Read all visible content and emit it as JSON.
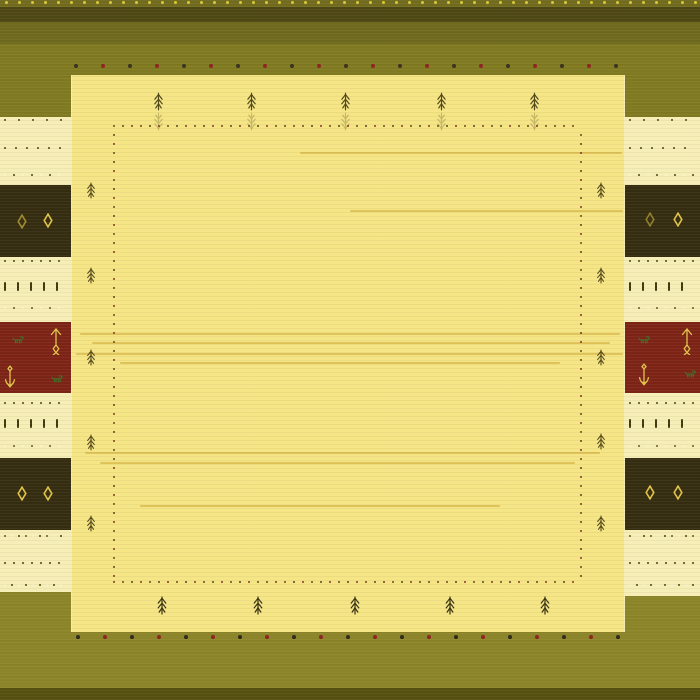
{
  "scene": {
    "name": "yellow-gabbeh-rug"
  },
  "palette": {
    "top_selvedge": "#716b1e",
    "top_dark": "#4d4714",
    "olive_dark": "#6e691d",
    "olive": "#7f7a21",
    "olive_bright": "#8b8428",
    "bottom_dark": "#55500f",
    "field": "#f5e585",
    "margin_cream": "#f6eeb6",
    "block_dark": "#342c10",
    "block_red": "#7c2316",
    "gold": "#e2c44a",
    "motif_green": "#3f6d28",
    "selvedge_dot_yellow": "#d8c733",
    "guard_dot_dark": "#38301f",
    "guard_dot_red": "#8e2121"
  },
  "rug": {
    "regions": [
      {
        "name": "top-selvedge-band",
        "x": 0,
        "y": 0,
        "w": 700,
        "h": 7,
        "color": "#716b1e",
        "tex": "olive"
      },
      {
        "name": "top-dark-band",
        "x": 0,
        "y": 7,
        "w": 700,
        "h": 15,
        "color": "#4d4714",
        "tex": "olive"
      },
      {
        "name": "top-olive-dark-band",
        "x": 0,
        "y": 22,
        "w": 700,
        "h": 22,
        "color": "#6e691d",
        "tex": "olive"
      },
      {
        "name": "top-olive-band",
        "x": 0,
        "y": 44,
        "w": 700,
        "h": 31,
        "color": "#7f7a21",
        "tex": "olive"
      },
      {
        "name": "bottom-olive-band",
        "x": 0,
        "y": 632,
        "w": 700,
        "h": 56,
        "color": "#8b8428",
        "tex": "olive"
      },
      {
        "name": "bottom-dark-band",
        "x": 0,
        "y": 688,
        "w": 700,
        "h": 12,
        "color": "#55500f",
        "tex": "olive"
      },
      {
        "name": "left-margin",
        "x": 0,
        "y": 75,
        "w": 72,
        "h": 557,
        "color": "#f6eeb6",
        "tex": "cream"
      },
      {
        "name": "right-margin",
        "x": 624,
        "y": 75,
        "w": 76,
        "h": 557,
        "color": "#f6eeb6",
        "tex": "cream"
      },
      {
        "name": "field",
        "x": 72,
        "y": 75,
        "w": 552,
        "h": 557,
        "color": "#f5e585",
        "tex": "field"
      },
      {
        "name": "left-olive-block-top",
        "x": 0,
        "y": 75,
        "w": 71,
        "h": 42,
        "color": "#7f7a21",
        "tex": "olive"
      },
      {
        "name": "right-olive-block-top",
        "x": 625,
        "y": 75,
        "w": 75,
        "h": 42,
        "color": "#7f7a21",
        "tex": "olive"
      },
      {
        "name": "left-dark-block-top",
        "x": 0,
        "y": 185,
        "w": 71,
        "h": 72,
        "color": "#342c10",
        "tex": "dark"
      },
      {
        "name": "right-dark-block-top",
        "x": 625,
        "y": 185,
        "w": 75,
        "h": 72,
        "color": "#342c10",
        "tex": "dark"
      },
      {
        "name": "left-red-block",
        "x": 0,
        "y": 322,
        "w": 71,
        "h": 71,
        "color": "#7c2316",
        "tex": "red"
      },
      {
        "name": "right-red-block",
        "x": 625,
        "y": 322,
        "w": 75,
        "h": 71,
        "color": "#7c2316",
        "tex": "red"
      },
      {
        "name": "left-dark-block-bottom",
        "x": 0,
        "y": 458,
        "w": 71,
        "h": 72,
        "color": "#342c10",
        "tex": "dark"
      },
      {
        "name": "right-dark-block-bottom",
        "x": 625,
        "y": 458,
        "w": 75,
        "h": 72,
        "color": "#342c10",
        "tex": "dark"
      },
      {
        "name": "left-olive-block-bottom",
        "x": 0,
        "y": 592,
        "w": 71,
        "h": 40,
        "color": "#8b8428",
        "tex": "olive"
      },
      {
        "name": "right-olive-block-bottom",
        "x": 625,
        "y": 596,
        "w": 75,
        "h": 36,
        "color": "#8b8428",
        "tex": "olive"
      }
    ],
    "field_streaks": [
      {
        "y": 152,
        "x1": 300,
        "x2": 622
      },
      {
        "y": 210,
        "x1": 350,
        "x2": 623
      },
      {
        "y": 333,
        "x1": 80,
        "x2": 620
      },
      {
        "y": 342,
        "x1": 92,
        "x2": 610
      },
      {
        "y": 353,
        "x1": 76,
        "x2": 623
      },
      {
        "y": 362,
        "x1": 120,
        "x2": 560
      },
      {
        "y": 452,
        "x1": 85,
        "x2": 600
      },
      {
        "y": 462,
        "x1": 100,
        "x2": 575
      },
      {
        "y": 505,
        "x1": 140,
        "x2": 500
      }
    ],
    "streak_color": "#c89e2a",
    "dot_rows": [
      {
        "name": "selvedge-dot-row",
        "y": 2,
        "x1": 6,
        "x2": 696,
        "step": 13,
        "size": 3,
        "colors": [
          "#d8c733"
        ]
      },
      {
        "name": "top-guard-dot-row",
        "y": 66,
        "x1": 76,
        "x2": 622,
        "step": 27,
        "size": 4,
        "colors": [
          "#38301f",
          "#8e2121"
        ]
      },
      {
        "name": "bottom-guard-dot-row",
        "y": 637,
        "x1": 78,
        "x2": 626,
        "step": 27,
        "size": 4,
        "colors": [
          "#2c281a",
          "#8e2121"
        ]
      }
    ],
    "inner_border": {
      "name": "inner-dotted-border",
      "x1": 114,
      "y1": 126,
      "x2": 581,
      "y2": 582,
      "step": 9,
      "size": 2.6,
      "colors": [
        "#6f421b",
        "#803024",
        "#57401f"
      ]
    },
    "margin_rows": {
      "left": {
        "x1": 5,
        "x2": 66
      },
      "right": {
        "x1": 630,
        "x2": 694
      },
      "rows": [
        {
          "y": 120,
          "type": "dot",
          "step": 14,
          "size": 2.6,
          "colors": [
            "#4a4012"
          ]
        },
        {
          "y": 148,
          "type": "dot",
          "step": 11,
          "size": 2.2,
          "colors": [
            "#4a4012"
          ]
        },
        {
          "y": 175,
          "type": "dot",
          "step": 9,
          "size": 2.4,
          "colors": [
            "#faf3d2",
            "#4a4012"
          ]
        },
        {
          "y": 261,
          "type": "dot",
          "step": 9,
          "size": 2.2,
          "colors": [
            "#454211"
          ]
        },
        {
          "y": 286,
          "type": "dash",
          "step": 13,
          "w": 2,
          "h": 9,
          "colors": [
            "#3e390e"
          ]
        },
        {
          "y": 308,
          "type": "dot",
          "step": 9,
          "size": 2.2,
          "colors": [
            "#faf3d2",
            "#6a5a20"
          ]
        },
        {
          "y": 403,
          "type": "dot",
          "step": 9,
          "size": 2.2,
          "colors": [
            "#454211"
          ]
        },
        {
          "y": 423,
          "type": "dash",
          "step": 13,
          "w": 2,
          "h": 9,
          "colors": [
            "#3e390e"
          ]
        },
        {
          "y": 446,
          "type": "dot",
          "step": 9,
          "size": 2.2,
          "colors": [
            "#faf3d2",
            "#6a5a20"
          ]
        },
        {
          "y": 536,
          "type": "dot",
          "step": 7,
          "size": 2,
          "colors": [
            "#6a5a20",
            "#faf3d2",
            "#4a4012"
          ]
        },
        {
          "y": 563,
          "type": "dot",
          "step": 9,
          "size": 2.6,
          "colors": [
            "#4a4012"
          ]
        },
        {
          "y": 585,
          "type": "dot",
          "step": 7,
          "size": 2,
          "colors": [
            "#faf3d2",
            "#4a4012"
          ]
        }
      ]
    },
    "motifs": {
      "trees": [
        {
          "x": 158,
          "y": 92,
          "w": 11,
          "h": 19,
          "color": "#4f4716",
          "reflect": true
        },
        {
          "x": 251,
          "y": 92,
          "w": 11,
          "h": 19,
          "color": "#4f4716",
          "reflect": true
        },
        {
          "x": 345,
          "y": 92,
          "w": 11,
          "h": 19,
          "color": "#4f4716",
          "reflect": true
        },
        {
          "x": 441,
          "y": 92,
          "w": 11,
          "h": 19,
          "color": "#4f4716",
          "reflect": true
        },
        {
          "x": 534,
          "y": 92,
          "w": 11,
          "h": 19,
          "color": "#4f4716",
          "reflect": true
        },
        {
          "x": 162,
          "y": 596,
          "w": 12,
          "h": 19,
          "color": "#3a3414",
          "reflect": false
        },
        {
          "x": 258,
          "y": 596,
          "w": 12,
          "h": 19,
          "color": "#3a3414",
          "reflect": false
        },
        {
          "x": 355,
          "y": 596,
          "w": 12,
          "h": 19,
          "color": "#3a3414",
          "reflect": false
        },
        {
          "x": 450,
          "y": 596,
          "w": 12,
          "h": 19,
          "color": "#3a3414",
          "reflect": false
        },
        {
          "x": 545,
          "y": 596,
          "w": 12,
          "h": 19,
          "color": "#3a3414",
          "reflect": false
        },
        {
          "x": 91,
          "y": 182,
          "w": 10,
          "h": 17,
          "color": "#55491a",
          "reflect": false
        },
        {
          "x": 91,
          "y": 267,
          "w": 10,
          "h": 17,
          "color": "#55491a",
          "reflect": false
        },
        {
          "x": 91,
          "y": 349,
          "w": 10,
          "h": 17,
          "color": "#55491a",
          "reflect": false
        },
        {
          "x": 91,
          "y": 434,
          "w": 10,
          "h": 17,
          "color": "#55491a",
          "reflect": false
        },
        {
          "x": 91,
          "y": 515,
          "w": 10,
          "h": 17,
          "color": "#55491a",
          "reflect": false
        },
        {
          "x": 601,
          "y": 182,
          "w": 10,
          "h": 17,
          "color": "#55491a",
          "reflect": false
        },
        {
          "x": 601,
          "y": 267,
          "w": 10,
          "h": 17,
          "color": "#55491a",
          "reflect": false
        },
        {
          "x": 601,
          "y": 349,
          "w": 10,
          "h": 17,
          "color": "#55491a",
          "reflect": false
        },
        {
          "x": 601,
          "y": 433,
          "w": 10,
          "h": 17,
          "color": "#55491a",
          "reflect": false
        },
        {
          "x": 601,
          "y": 515,
          "w": 10,
          "h": 17,
          "color": "#55491a",
          "reflect": false
        }
      ],
      "diamonds": [
        {
          "x": 22,
          "y": 214,
          "w": 10,
          "h": 15,
          "color": "#a08c2c"
        },
        {
          "x": 48,
          "y": 213,
          "w": 10,
          "h": 15,
          "color": "#e2c44a"
        },
        {
          "x": 650,
          "y": 212,
          "w": 10,
          "h": 15,
          "color": "#8f7f2a"
        },
        {
          "x": 678,
          "y": 212,
          "w": 10,
          "h": 15,
          "color": "#e2c44a"
        },
        {
          "x": 22,
          "y": 486,
          "w": 10,
          "h": 15,
          "color": "#e2c44a"
        },
        {
          "x": 48,
          "y": 486,
          "w": 10,
          "h": 15,
          "color": "#e2c44a"
        },
        {
          "x": 650,
          "y": 485,
          "w": 10,
          "h": 15,
          "color": "#e2c44a"
        },
        {
          "x": 678,
          "y": 485,
          "w": 10,
          "h": 15,
          "color": "#e2c44a"
        }
      ],
      "animals": [
        {
          "x": 18,
          "y": 335,
          "w": 13,
          "h": 9,
          "color": "#3f6d28"
        },
        {
          "x": 57,
          "y": 374,
          "w": 13,
          "h": 9,
          "color": "#3f6d28"
        },
        {
          "x": 644,
          "y": 335,
          "w": 13,
          "h": 9,
          "color": "#3f6d28"
        },
        {
          "x": 690,
          "y": 369,
          "w": 13,
          "h": 9,
          "color": "#3f6d28"
        }
      ],
      "arrows": [
        {
          "x": 56,
          "y": 328,
          "w": 12,
          "h": 27,
          "color": "#e2c44a"
        },
        {
          "x": 687,
          "y": 328,
          "w": 12,
          "h": 27,
          "color": "#e2c44a"
        }
      ],
      "anchors": [
        {
          "x": 10,
          "y": 365,
          "w": 14,
          "h": 24,
          "color": "#e2c44a"
        },
        {
          "x": 644,
          "y": 363,
          "w": 14,
          "h": 24,
          "color": "#e2c44a"
        }
      ]
    }
  }
}
